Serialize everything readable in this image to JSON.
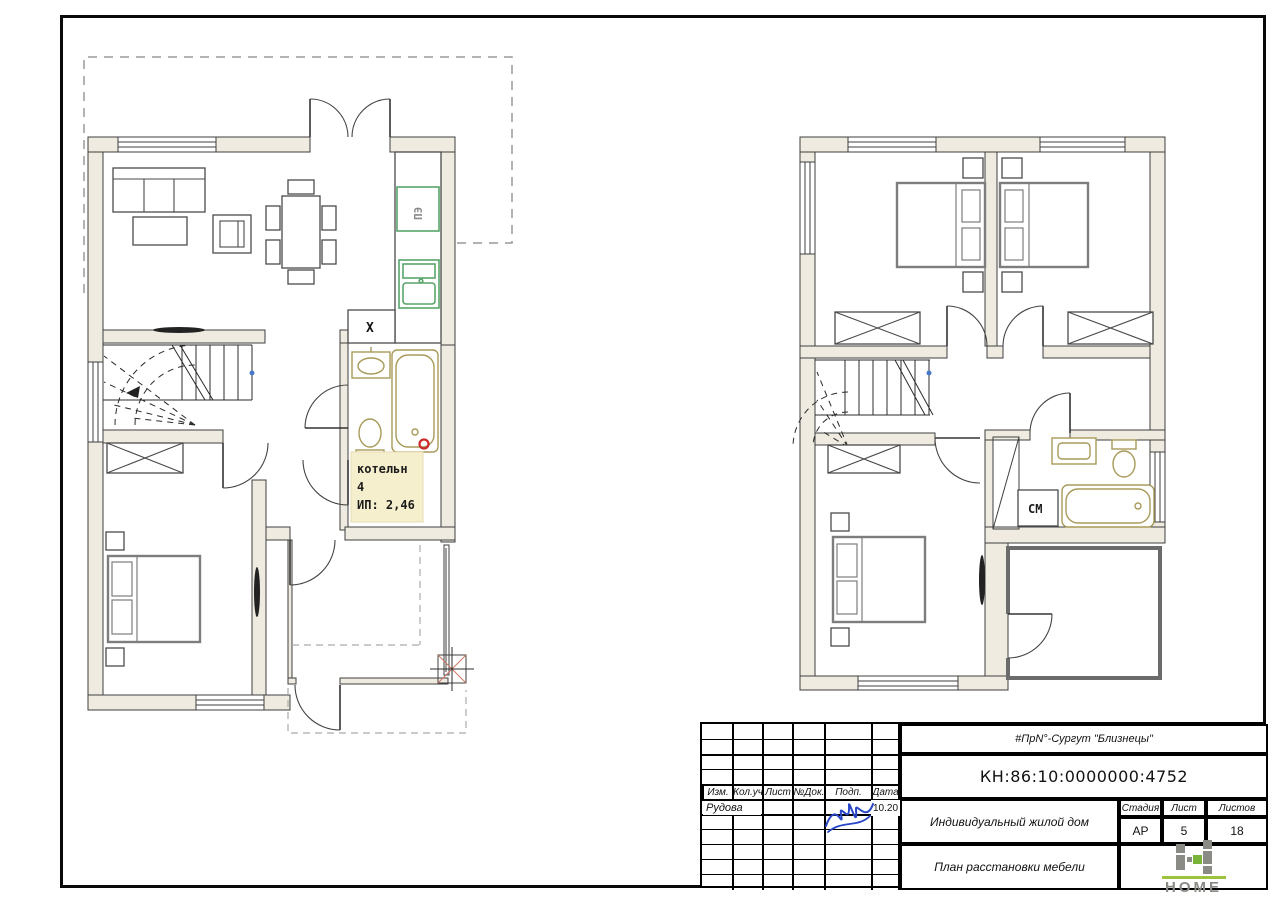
{
  "page": {
    "background": "#ffffff"
  },
  "frame": {
    "color": "#0a0a0a"
  },
  "plans": {
    "first_floor": {
      "boiler_label": {
        "line1": "котельн",
        "line2": "4",
        "line3": "ИП: 2,46"
      },
      "stove_label": "ПЭ",
      "hood_label": "X"
    },
    "second_floor": {
      "washer_label": "СМ"
    }
  },
  "title_block": {
    "project": "#ПрN°-Сургут \"Близнецы\"",
    "cadastral": "КН:86:10:0000000:4752",
    "object_name": "Индивидуальный жилой дом",
    "drawing_name": "План расстановки мебели",
    "columns": [
      "Изм.",
      "Кол.уч",
      "Лист",
      "№Док.",
      "Подп.",
      "Дата"
    ],
    "author": "Рудова",
    "date": "10.20",
    "stage_label": "Стадия",
    "sheet_label": "Лист",
    "sheets_label": "Листов",
    "stage": "АР",
    "sheet_number": "5",
    "sheets_total": "18",
    "logo_text": "HOME"
  },
  "colors": {
    "wall_fill": "#efebe0",
    "line": "#3f3f3f",
    "fixture_tan": "#a89a58",
    "appliance_green": "#58a46a",
    "label_bg": "#f6efcd",
    "dash_gray": "#9a9a9a",
    "signature_blue": "#2a46c8",
    "logo_green": "#7ab33a",
    "logo_gray": "#8b8b86",
    "accent_red": "#cc2b2b",
    "balcony_gray": "#6b6b6b",
    "blue_dot": "#4a78c8"
  }
}
